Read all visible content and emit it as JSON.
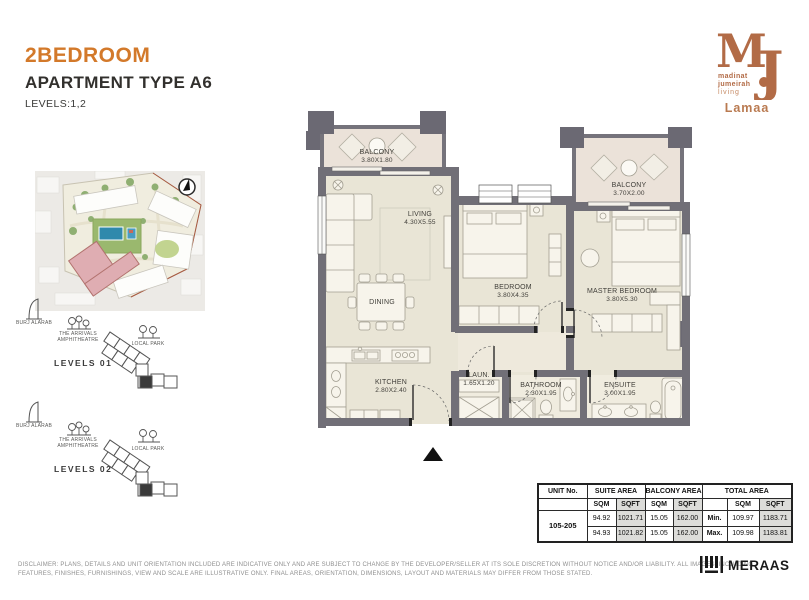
{
  "header": {
    "title": "2BEDROOM",
    "subtitle": "APARTMENT TYPE A6",
    "levels": "LEVELS:1,2"
  },
  "brand": {
    "monogram_m": "M",
    "monogram_j": "J",
    "tagline_1": "madinat",
    "tagline_2": "jumeirah",
    "tagline_3": "living",
    "project": "Lamaa",
    "developer": "MERAAS",
    "copper": "#b26b46",
    "orange": "#d3792a"
  },
  "sidebar": {
    "landmark_burj": "BURJ ALARAB",
    "landmark_amphitheatre": "THE ARRIVALS AMPHITHEATRE",
    "landmark_park": "LOCAL PARK",
    "level_set_1": "LEVELS 01",
    "level_set_2": "LEVELS 02"
  },
  "plan": {
    "rooms": [
      {
        "name": "BALCONY",
        "dims": "3.80X1.80"
      },
      {
        "name": "BALCONY",
        "dims": "3.70X2.00"
      },
      {
        "name": "LIVING",
        "dims": "4.30X5.55"
      },
      {
        "name": "DINING",
        "dims": ""
      },
      {
        "name": "BEDROOM",
        "dims": "3.80X4.35"
      },
      {
        "name": "MASTER BEDROOM",
        "dims": "3.80X5.30"
      },
      {
        "name": "KITCHEN",
        "dims": "2.80X2.40"
      },
      {
        "name": "LAUN.",
        "dims": "1.65X1.20"
      },
      {
        "name": "BATHROOM",
        "dims": "2.30X1.95"
      },
      {
        "name": "ENSUITE",
        "dims": "3.00X1.95"
      }
    ]
  },
  "area_table": {
    "header_unit": "UNIT No.",
    "header_suite": "SUITE AREA",
    "header_balcony": "BALCONY AREA",
    "header_total": "TOTAL AREA",
    "sub": [
      "SQM",
      "SQFT",
      "SQM",
      "SQFT",
      "",
      "SQM",
      "SQFT"
    ],
    "unit_no": "105-205",
    "rows": [
      [
        "94.92",
        "1021.71",
        "15.05",
        "162.00",
        "Min.",
        "109.97",
        "1183.71"
      ],
      [
        "94.93",
        "1021.82",
        "15.05",
        "162.00",
        "Max.",
        "109.98",
        "1183.81"
      ]
    ]
  },
  "footer": {
    "disclaimer_1": "DISCLAIMER: PLANS, DETAILS AND UNIT ORIENTATION INCLUDED ARE INDICATIVE ONLY AND ARE SUBJECT TO CHANGE BY THE DEVELOPER/SELLER AT ITS SOLE DISCRETION WITHOUT NOTICE AND/OR LIABILITY. ALL IMAGES, INCLUDING",
    "disclaimer_2": "FEATURES, FINISHES, FURNISHINGS, VIEW AND SCALE ARE ILLUSTRATIVE ONLY. FINAL AREAS, ORIENTATION, DIMENSIONS, LAYOUT AND MATERIALS MAY DIFFER FROM THOSE STATED."
  }
}
